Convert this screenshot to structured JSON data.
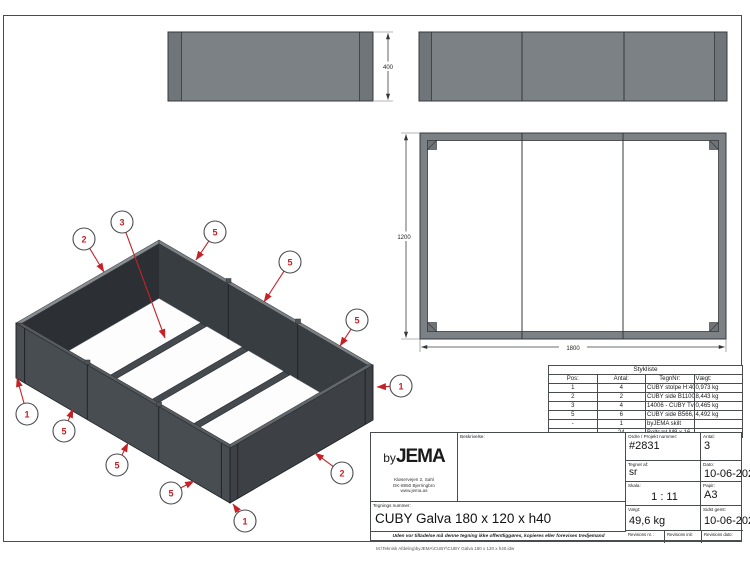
{
  "views": {
    "side_elevation": {
      "dim_height": "400"
    },
    "plan": {
      "dim_width": "1200",
      "dim_length": "1800"
    }
  },
  "iso": {
    "balloons": [
      {
        "n": "2",
        "cx": 84,
        "cy": 239,
        "tx": 104,
        "ty": 272
      },
      {
        "n": "3",
        "cx": 122,
        "cy": 222,
        "tx": 165,
        "ty": 338
      },
      {
        "n": "5",
        "cx": 215,
        "cy": 232,
        "tx": 196,
        "ty": 260
      },
      {
        "n": "5",
        "cx": 290,
        "cy": 262,
        "tx": 264,
        "ty": 302
      },
      {
        "n": "5",
        "cx": 357,
        "cy": 320,
        "tx": 340,
        "ty": 346
      },
      {
        "n": "1",
        "cx": 27,
        "cy": 414,
        "tx": 17,
        "ty": 378
      },
      {
        "n": "5",
        "cx": 64,
        "cy": 431,
        "tx": 73,
        "ty": 409
      },
      {
        "n": "5",
        "cx": 117,
        "cy": 465,
        "tx": 128,
        "ty": 443
      },
      {
        "n": "5",
        "cx": 171,
        "cy": 493,
        "tx": 194,
        "ty": 481
      },
      {
        "n": "1",
        "cx": 245,
        "cy": 521,
        "tx": 233,
        "ty": 504
      },
      {
        "n": "2",
        "cx": 342,
        "cy": 473,
        "tx": 315,
        "ty": 453
      },
      {
        "n": "1",
        "cx": 401,
        "cy": 386,
        "tx": 377,
        "ty": 387
      }
    ]
  },
  "parts_list": {
    "title": "Stykliste",
    "headers": {
      "pos": "Pos:",
      "antal": "Antal:",
      "tegnnr": "TegnNr:",
      "vaegt": "Vægt:"
    },
    "rows": [
      [
        "1",
        "4",
        "CUBY stolpe H:400 Galva",
        "0,973 kg"
      ],
      [
        "2",
        "2",
        "CUBY side B1100 H400",
        "8,443 kg"
      ],
      [
        "3",
        "4",
        "14006 - CUBY Tværstiver 1200 Galva",
        "0,465 kg"
      ],
      [
        "5",
        "6",
        "CUBY side B566,67 H400 Galva",
        "4,492 kg"
      ],
      [
        "-",
        "1",
        "byJEMA skilt",
        ""
      ],
      [
        "-",
        "24",
        "Boltsæt M8 x 16",
        ""
      ]
    ]
  },
  "title_block": {
    "logo": {
      "by": "by",
      "jema": "JEMA"
    },
    "address": [
      "Kløservejen 2, Sahl",
      "DK-8850 Bjerringbro",
      "www.jema.as"
    ],
    "labels": {
      "beskrivelse": "Beskrivelse:",
      "ordre": "Ordre / Projekt nummer:",
      "antal": "Antal:",
      "tegnet_af": "Tegnet af:",
      "dato": "Dato:",
      "skala": "Skala:",
      "papir": "Papir:",
      "vaegt": "Vægt:",
      "sidst_gemt": "Sidst gemt:",
      "tegnings_nummer": "Tegnings nummer:",
      "rev_nr": "Revisions nr. :",
      "rev_init": "Revisions init:",
      "rev_dato": "Revisions dato:"
    },
    "values": {
      "ordre": "#2831",
      "antal": "3",
      "tegnet_af": "sr",
      "dato": "10-06-2021",
      "skala": "1 : 11",
      "papir": "A3",
      "vaegt": "49,6 kg",
      "sidst_gemt": "10-06-2021",
      "tegnings_nummer": "CUBY Galva 180 x 120 x h40"
    },
    "disclaimer": "Uden vor tilladelse må denne tegning ikke offentliggøres, kopieres eller forevises tredjemand",
    "footer_path": "M:\\Teknisk Afdeling\\byJEMA\\CUBY\\CUBY Galva 180 x 120 x h40.idw"
  },
  "colors": {
    "accent_red": "#c52228",
    "metal_gray": "#7c8186"
  }
}
